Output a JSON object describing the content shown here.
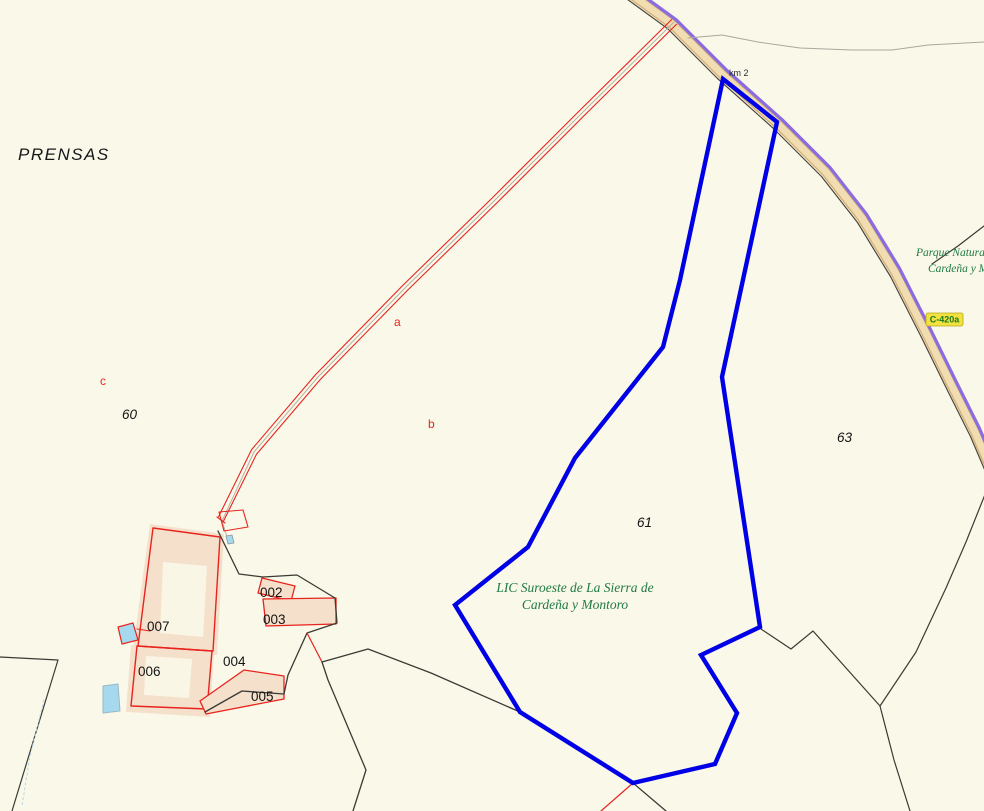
{
  "map": {
    "width": 984,
    "height": 811,
    "colors": {
      "background": "#faf8e9",
      "road_casing": "#d8b179",
      "road_surface": "#f0ddb2",
      "road_edge": "#4a463c",
      "road_purple": "#8a6ce0",
      "gray_path": "#a8a89e",
      "boundary_black": "#3a3a34",
      "parcel_red": "#e8241e",
      "building_fill": "#f5e0cb",
      "courtyard_fill": "#faf6e6",
      "pool_blue": "#a6d9ed",
      "selection_blue": "#0000e6",
      "badge_yellow": "#f2e13e",
      "protected_green": "#1f7a42"
    },
    "paths": {
      "road": "628,-8 672,24 722,74 778,124 826,172 862,218 895,272 926,333 952,386 975,432 992,472",
      "track": "674,22 585,110 495,200 405,288 318,377 254,452 221,519"
    },
    "layers": [
      {
        "kind": "polyline",
        "name": "road-casing",
        "interact": false,
        "ref": "road",
        "stroke": "#d8b179",
        "w": 10
      },
      {
        "kind": "polyline",
        "name": "road-surface",
        "interact": false,
        "ref": "road",
        "stroke": "#f0ddb2",
        "w": 7
      },
      {
        "kind": "polyline",
        "name": "road-edge-line",
        "interact": false,
        "ref": "road",
        "stroke": "#4a463c",
        "w": 1.2,
        "t": "translate(-4.5,4.5)"
      },
      {
        "kind": "polyline",
        "name": "road-purple-line",
        "interact": false,
        "ref": "road",
        "stroke": "#8a6ce0",
        "w": 3.2,
        "t": "translate(4.2,-4.2)"
      },
      {
        "kind": "polyline",
        "name": "gray-path-curve",
        "interact": false,
        "pts": "688,38 722,35 758,42 800,48 852,50 892,50 928,45 984,42",
        "stroke": "#a8a89e",
        "w": 1
      },
      {
        "kind": "polyline",
        "name": "boundary-northeast",
        "interact": false,
        "pts": "984,226 958,246 932,264",
        "stroke": "#3a3a34",
        "w": 1.2
      },
      {
        "kind": "polyline",
        "name": "boundary-southeast-curve",
        "interact": false,
        "pts": "986,492 966,542 946,588 916,652 880,706 894,760 910,811",
        "stroke": "#3a3a34",
        "w": 1.2
      },
      {
        "kind": "polyline",
        "name": "boundary-zigzag-east",
        "interact": false,
        "pts": "761,629 791,649 813,631 880,706",
        "stroke": "#3a3a34",
        "w": 1.2
      },
      {
        "kind": "polyline",
        "name": "track-red-edge-upper",
        "interact": false,
        "ref": "track",
        "stroke": "#e8241e",
        "w": 1.1,
        "t": "translate(-2.4,-2.4)"
      },
      {
        "kind": "polyline",
        "name": "track-red-edge-lower",
        "interact": false,
        "ref": "track",
        "stroke": "#e8241e",
        "w": 1.1,
        "t": "translate(2.4,2.4)"
      },
      {
        "kind": "polyline",
        "name": "track-gray-centerline",
        "interact": false,
        "pts": "674,22 585,110 495,200 405,288 318,377 254,452 222,521 229,543",
        "stroke": "#b5b0a2",
        "w": 1
      },
      {
        "kind": "polyline",
        "name": "track-end-cap",
        "interact": false,
        "pts": "217,517 225,523",
        "stroke": "#e8241e",
        "w": 1.1
      },
      {
        "kind": "polygon",
        "name": "small-red-parcel-track-end",
        "interact": true,
        "pts": "219,512 243,510 248,527 224,531",
        "stroke": "#e8241e",
        "w": 1.1
      },
      {
        "kind": "polygon",
        "name": "tiny-pool",
        "interact": false,
        "pts": "226,536 232,535 234,543 228,544",
        "fill": "#a6d9ed",
        "stroke": "#8899a0",
        "w": 0.8
      },
      {
        "kind": "polyline",
        "name": "boundary-southwest",
        "interact": false,
        "pts": "0,657 58,660 12,811",
        "stroke": "#3a3a34",
        "w": 1.2
      },
      {
        "kind": "polyline",
        "name": "stream-dashed",
        "interact": false,
        "pts": "44,700 30,756 22,806",
        "stroke": "#b9d4e6",
        "w": 1,
        "dash": "2,3"
      },
      {
        "kind": "polygon",
        "name": "building-fill-007",
        "interact": false,
        "pts": "150,524 224,534 217,655 133,649",
        "fill": "#f5e0cb"
      },
      {
        "kind": "polygon",
        "name": "courtyard-007",
        "interact": false,
        "pts": "163,562 207,566 203,637 160,633",
        "fill": "#faf6e6"
      },
      {
        "kind": "polygon",
        "name": "building-fill-006",
        "interact": false,
        "pts": "131,645 214,650 210,717 126,712",
        "fill": "#f5e0cb"
      },
      {
        "kind": "polygon",
        "name": "courtyard-006",
        "interact": false,
        "pts": "146,656 192,659 189,698 144,695",
        "fill": "#faf6e6"
      },
      {
        "kind": "polygon",
        "name": "parcel-007-outline",
        "interact": true,
        "pts": "153,528 220,537 213,651 138,646",
        "stroke": "#e8241e",
        "w": 1.4
      },
      {
        "kind": "polygon",
        "name": "parcel-006-outline",
        "interact": true,
        "pts": "137,646 212,651 207,709 131,706",
        "stroke": "#e8241e",
        "w": 1.4
      },
      {
        "kind": "polyline",
        "name": "pool-parcel-connector",
        "interact": false,
        "pts": "137,629 150,631",
        "stroke": "#e8241e",
        "w": 1.1
      },
      {
        "kind": "polygon",
        "name": "pool-upper",
        "interact": true,
        "pts": "118,627 133,623 138,640 122,644",
        "fill": "#a6d9ed",
        "stroke": "#e8241e",
        "w": 1.2
      },
      {
        "kind": "polygon",
        "name": "pool-lower",
        "interact": true,
        "pts": "103,686 118,684 120,711 103,713",
        "fill": "#a6d9ed",
        "stroke": "#9ab7c6",
        "w": 1
      },
      {
        "kind": "polygon",
        "name": "parcel-002-outline",
        "interact": true,
        "pts": "262,578 295,586 291,601 258,593",
        "fill": "#f5e0cb",
        "stroke": "#e8241e",
        "w": 1.3
      },
      {
        "kind": "polygon",
        "name": "parcel-003-outline",
        "interact": true,
        "pts": "263,599 336,598 336,624 266,626",
        "fill": "#f5e0cb",
        "stroke": "#e8241e",
        "w": 1.3
      },
      {
        "kind": "polygon",
        "name": "parcel-005-outline",
        "interact": true,
        "pts": "244,670 284,676 284,699 206,714 200,701",
        "fill": "#f5e0cb",
        "stroke": "#e8241e",
        "w": 1.3
      },
      {
        "kind": "polyline",
        "name": "boundary-village-north",
        "interact": false,
        "pts": "218,531 239,574 263,577 297,575 335,598 337,623 307,633 288,675 284,694 242,691 205,712",
        "stroke": "#3a3a34",
        "w": 1.3
      },
      {
        "kind": "polyline",
        "name": "red-boundary-segment-1",
        "interact": false,
        "pts": "307,633 322,662",
        "stroke": "#e8241e",
        "w": 1.2
      },
      {
        "kind": "polyline",
        "name": "boundary-south-long",
        "interact": false,
        "pts": "322,662 328,680 366,770 353,811",
        "stroke": "#3a3a34",
        "w": 1.3
      },
      {
        "kind": "polyline",
        "name": "boundary-to-selection",
        "interact": false,
        "pts": "322,662 368,649 431,673 520,712",
        "stroke": "#3a3a34",
        "w": 1.3
      },
      {
        "kind": "polyline",
        "name": "boundary-south-exit",
        "interact": false,
        "pts": "633,783 666,811",
        "stroke": "#3a3a34",
        "w": 1.3
      },
      {
        "kind": "polyline",
        "name": "red-boundary-segment-2",
        "interact": false,
        "pts": "633,783 601,811",
        "stroke": "#e8241e",
        "w": 1.2
      },
      {
        "kind": "polygon",
        "name": "parcel-61-selection-outline",
        "interact": true,
        "pts": "723,79 777,122 722,377 760,627 701,655 737,713 715,764 633,783 520,712 455,605 528,547 575,458 663,347 680,280",
        "stroke": "#0000e6",
        "w": 4.4,
        "join": "miter",
        "cap": "butt"
      },
      {
        "kind": "rect",
        "name": "road-ref-badge",
        "interact": false,
        "x": 926,
        "y": 313,
        "rw": 37,
        "rh": 13,
        "rx": 2,
        "fill": "#f2e13e",
        "stroke": "#b7a81f",
        "w": 0.8
      }
    ],
    "labels": [
      {
        "name": "label-toponym-prensas",
        "text": "PRENSAS",
        "x": 18,
        "y": 160,
        "cls": "toponym"
      },
      {
        "name": "label-parcel-60",
        "text": "60",
        "x": 122,
        "y": 419,
        "cls": "pnum-i"
      },
      {
        "name": "label-parcel-61",
        "text": "61",
        "x": 637,
        "y": 527,
        "cls": "pnum-i"
      },
      {
        "name": "label-parcel-63",
        "text": "63",
        "x": 837,
        "y": 442,
        "cls": "pnum-i"
      },
      {
        "name": "label-subparcel-007",
        "text": "007",
        "x": 147,
        "y": 631,
        "cls": "pnum"
      },
      {
        "name": "label-subparcel-006",
        "text": "006",
        "x": 138,
        "y": 676,
        "cls": "pnum"
      },
      {
        "name": "label-subparcel-004",
        "text": "004",
        "x": 223,
        "y": 666,
        "cls": "pnum"
      },
      {
        "name": "label-subparcel-002",
        "text": "002",
        "x": 260,
        "y": 597,
        "cls": "pnum"
      },
      {
        "name": "label-subparcel-003",
        "text": "003",
        "x": 263,
        "y": 624,
        "cls": "pnum"
      },
      {
        "name": "label-subparcel-005",
        "text": "005",
        "x": 251,
        "y": 701,
        "cls": "pnum"
      },
      {
        "name": "label-letter-a",
        "text": "a",
        "x": 394,
        "y": 326,
        "cls": "rletter"
      },
      {
        "name": "label-letter-b",
        "text": "b",
        "x": 428,
        "y": 428,
        "cls": "rletter"
      },
      {
        "name": "label-letter-c",
        "text": "c",
        "x": 100,
        "y": 385,
        "cls": "rletter"
      },
      {
        "name": "label-km-marker",
        "text": "km 2",
        "x": 729,
        "y": 76,
        "cls": "small"
      },
      {
        "name": "label-road-ref",
        "text": "C-420a",
        "x": 944.5,
        "y": 322.5,
        "cls": "badge",
        "anchor": "middle"
      },
      {
        "name": "label-park-line1",
        "text": "Parque Natural",
        "x": 916,
        "y": 256,
        "cls": "green"
      },
      {
        "name": "label-park-line2",
        "text": "Cardeña y M",
        "x": 928,
        "y": 272,
        "cls": "green"
      },
      {
        "name": "label-lic-line1",
        "text": "LIC Suroeste de La Sierra de",
        "x": 575,
        "y": 592,
        "cls": "green2",
        "anchor": "middle"
      },
      {
        "name": "label-lic-line2",
        "text": "Cardeña y Montoro",
        "x": 575,
        "y": 609,
        "cls": "green2",
        "anchor": "middle"
      }
    ]
  }
}
